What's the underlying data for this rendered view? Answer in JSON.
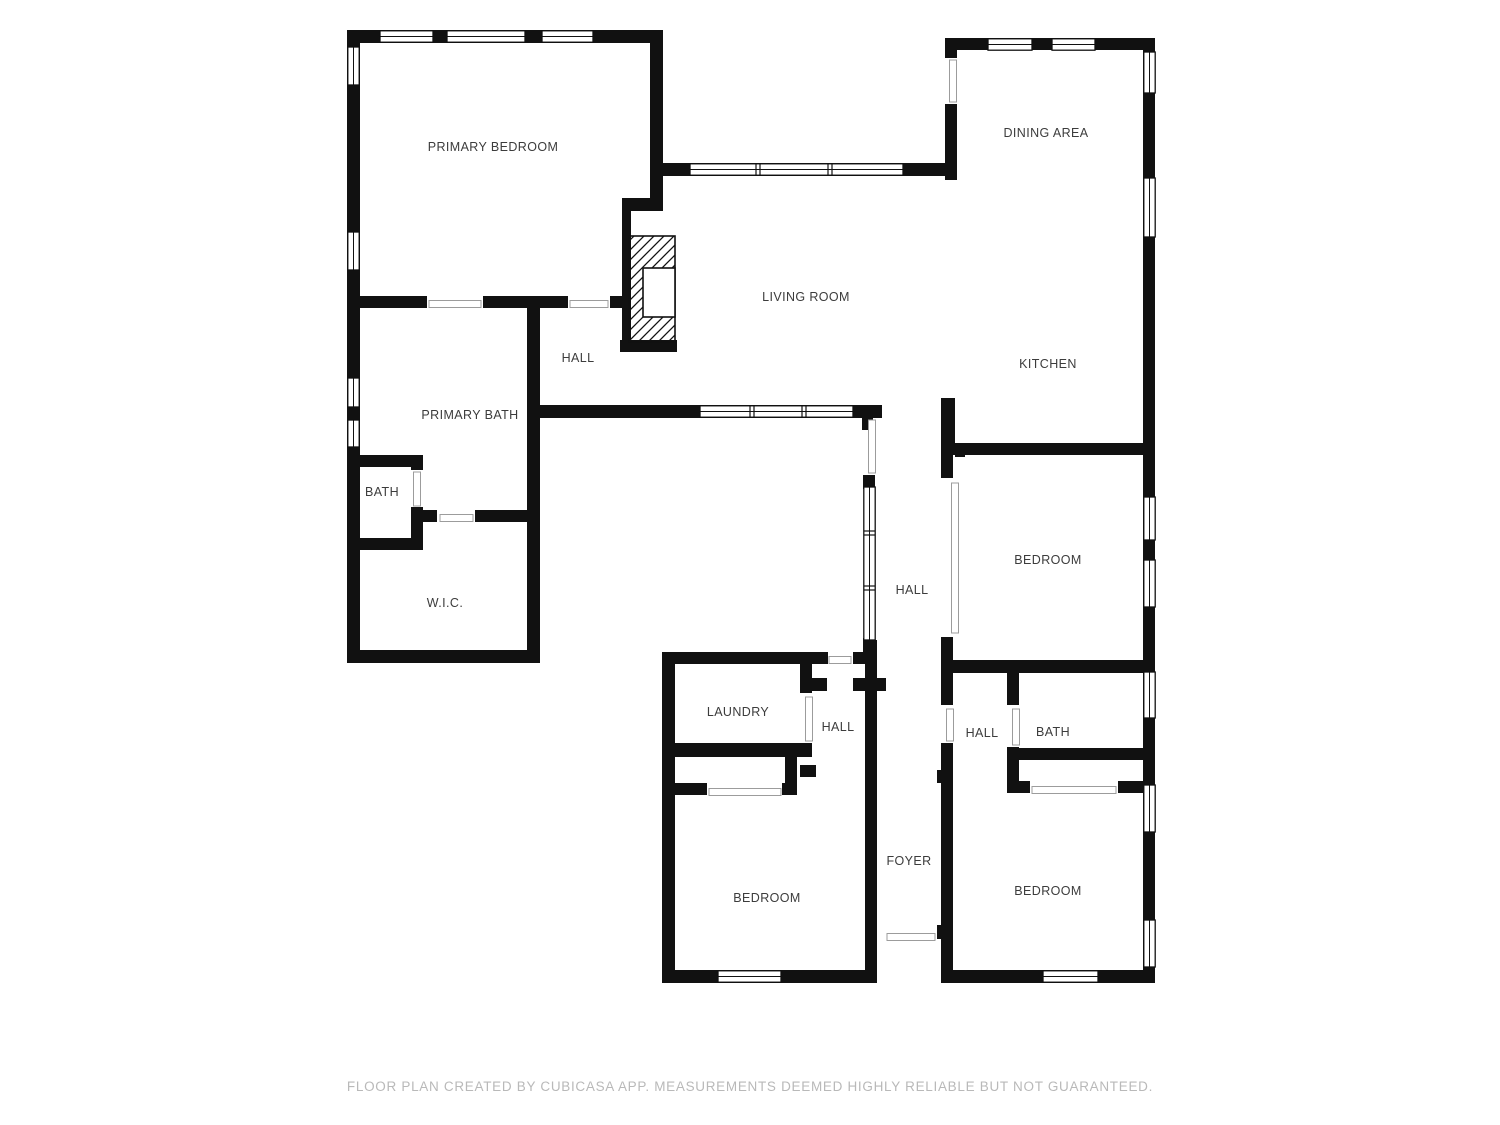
{
  "title": "Floor plan",
  "colors": {
    "wall": "#111111",
    "window_frame": "#111111",
    "door_line": "#9c9c9c",
    "label": "#3c3c3c",
    "footer": "#b9b9b9",
    "background": "#ffffff"
  },
  "rooms": [
    {
      "id": "primary-bedroom",
      "label": "PRIMARY BEDROOM"
    },
    {
      "id": "dining-area",
      "label": "DINING AREA"
    },
    {
      "id": "living-room",
      "label": "LIVING ROOM"
    },
    {
      "id": "kitchen",
      "label": "KITCHEN"
    },
    {
      "id": "hall-primary",
      "label": "HALL"
    },
    {
      "id": "primary-bath",
      "label": "PRIMARY BATH"
    },
    {
      "id": "bath-primary",
      "label": "BATH"
    },
    {
      "id": "wic",
      "label": "W.I.C."
    },
    {
      "id": "bedroom-east",
      "label": "BEDROOM"
    },
    {
      "id": "hall-center",
      "label": "HALL"
    },
    {
      "id": "laundry",
      "label": "LAUNDRY"
    },
    {
      "id": "hall-laundry",
      "label": "HALL"
    },
    {
      "id": "hall-east",
      "label": "HALL"
    },
    {
      "id": "bath-east",
      "label": "BATH"
    },
    {
      "id": "foyer",
      "label": "FOYER"
    },
    {
      "id": "bedroom-south",
      "label": "BEDROOM"
    },
    {
      "id": "bedroom-southeast",
      "label": "BEDROOM"
    }
  ],
  "footer": {
    "text": "FLOOR PLAN CREATED BY CUBICASA APP. MEASUREMENTS DEEMED HIGHLY RELIABLE BUT NOT GUARANTEED."
  }
}
